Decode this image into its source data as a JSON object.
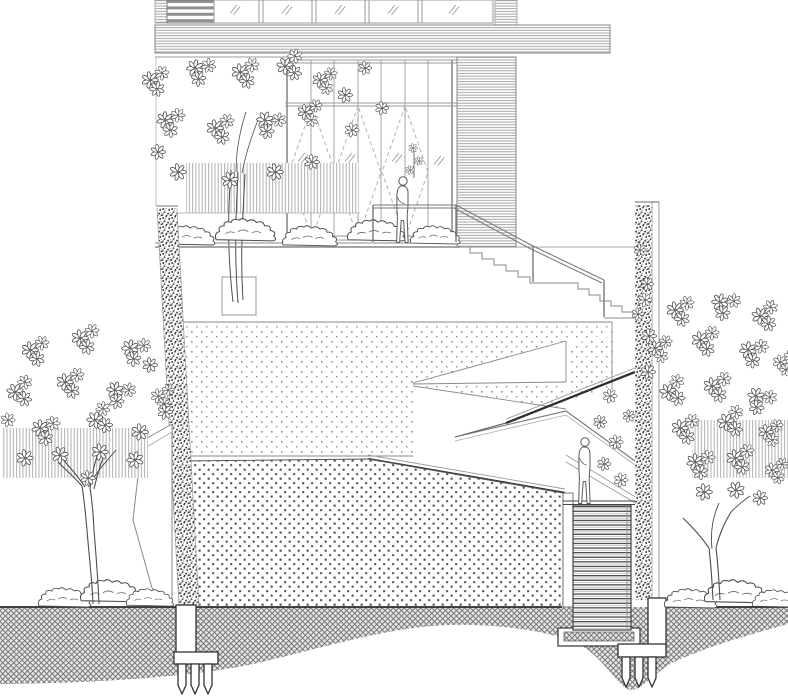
{
  "meta": {
    "title": "Architectural site section drawing",
    "description": "Monochrome line-drawn section and elevation through a terraced building entrance: glass curtain wall with three folding-door bays, louvered screens, switchback ramps cut through stippled earth fill, a sectioned stair, two green walls, three trees, shrubs, crosshatched ground and two pile foundations. Two human figures for scale.",
    "visible_text": "none"
  },
  "inventory": {
    "human_figures": 2,
    "figure_locations": [
      "building entrance behind guardrail",
      "lower stair landing"
    ],
    "upper_window_panels": 5,
    "door_bays_with_swing_diamonds": 3,
    "entry_stair_flights": 2,
    "section_stairs": 1,
    "trees": 3,
    "green_walls": 2,
    "hedgerows": 3,
    "shrub_clusters": 3,
    "planter_boxes": 1,
    "pile_groups": 2,
    "piles_per_group": 3
  },
  "colors": {
    "background": "#ffffff",
    "linework": "#555555",
    "light_linework": "#9a9a9a",
    "heavy_edge": "#2f2f2f",
    "stipple_light": "#909090",
    "stipple_dense": "#4f4f4f",
    "hatch_fill": "#e4e4e4",
    "hatch_line": "#707070",
    "stripe_panel": "#8f8f8f"
  },
  "patterns": {
    "upper_fill": "light stipple dot grid",
    "lower_fill": "dense dark stipple dot grid",
    "ground": "diagonal crosshatch band with wavy underside",
    "screens": "fine horizontal louver lines",
    "hedges": "fine vertical strokes",
    "green_walls": "dense organic speckle",
    "stair_section": "horizontal tread lines"
  }
}
